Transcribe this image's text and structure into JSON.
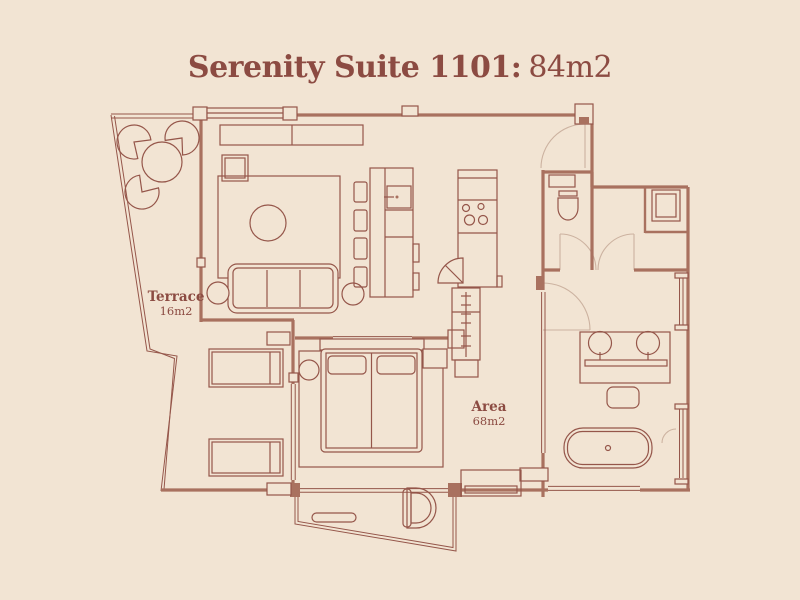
{
  "title": {
    "suite_label": "Serenity Suite 1101:",
    "suite_area": "84m2"
  },
  "rooms": {
    "terrace": {
      "label": "Terrace",
      "area": "16m2"
    },
    "interior": {
      "label": "Area",
      "area": "68m2"
    }
  },
  "colors": {
    "background": "#f2e4d3",
    "line": "#95564a",
    "wall": "#a9715f",
    "door_arc": "#ccb2a0",
    "text": "#8c4b42"
  }
}
